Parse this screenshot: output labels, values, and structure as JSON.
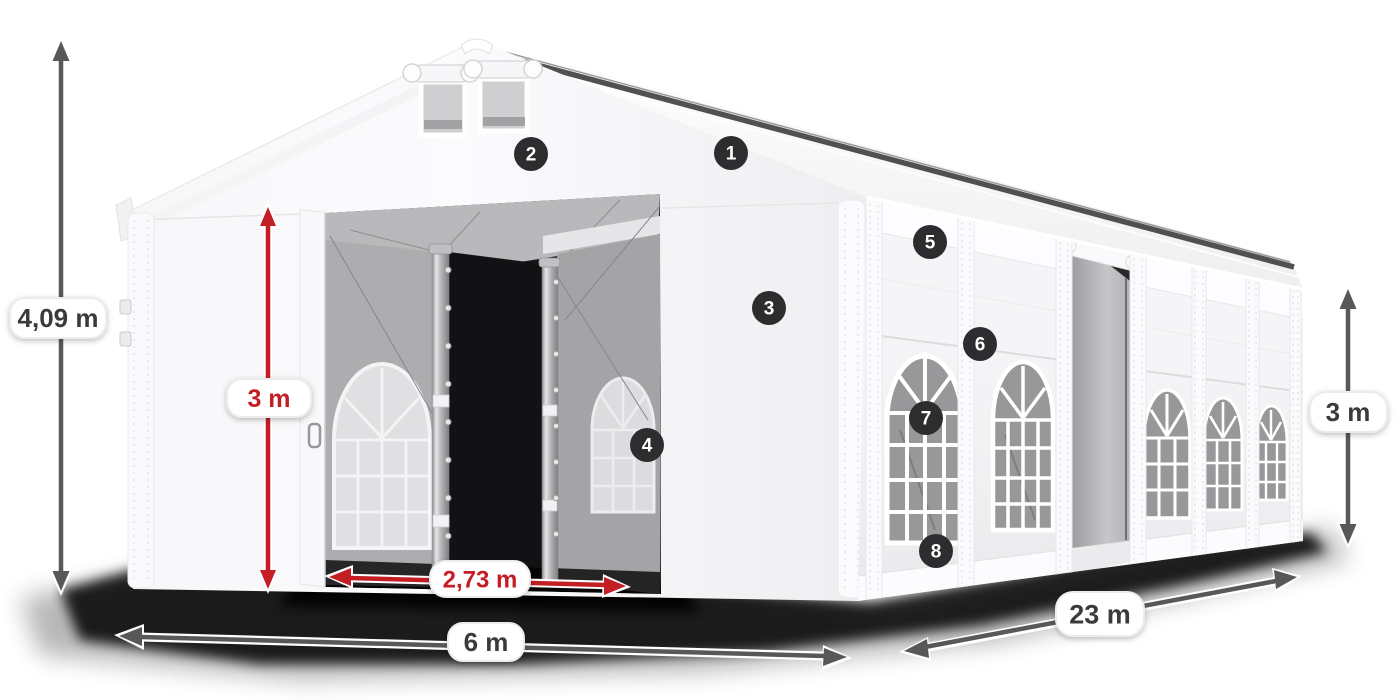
{
  "annotations": {
    "dimensions": [
      {
        "id": "total-height",
        "label": "4,09 m",
        "color_role": "gray"
      },
      {
        "id": "inner-height",
        "label": "3 m",
        "color_role": "red"
      },
      {
        "id": "door-width",
        "label": "2,73 m",
        "color_role": "red"
      },
      {
        "id": "width",
        "label": "6 m",
        "color_role": "gray"
      },
      {
        "id": "length",
        "label": "23 m",
        "color_role": "gray"
      },
      {
        "id": "side-height",
        "label": "3 m",
        "color_role": "gray"
      }
    ],
    "callouts": [
      {
        "number": "1"
      },
      {
        "number": "2"
      },
      {
        "number": "3"
      },
      {
        "number": "4"
      },
      {
        "number": "5"
      },
      {
        "number": "6"
      },
      {
        "number": "7"
      },
      {
        "number": "8"
      }
    ]
  },
  "colors": {
    "dimension_gray": "#58585a",
    "dimension_red": "#c41e25",
    "label_text_gray": "#3b3b3d",
    "label_text_red": "#c41e25",
    "pill_bg": "#ffffff",
    "pill_border": "#ececee",
    "badge_bg": "#2d2d2f",
    "badge_text": "#ffffff",
    "tent_white": "#fafafa",
    "interior_gray": "#aeaeb0",
    "shadow_black": "#000000"
  }
}
